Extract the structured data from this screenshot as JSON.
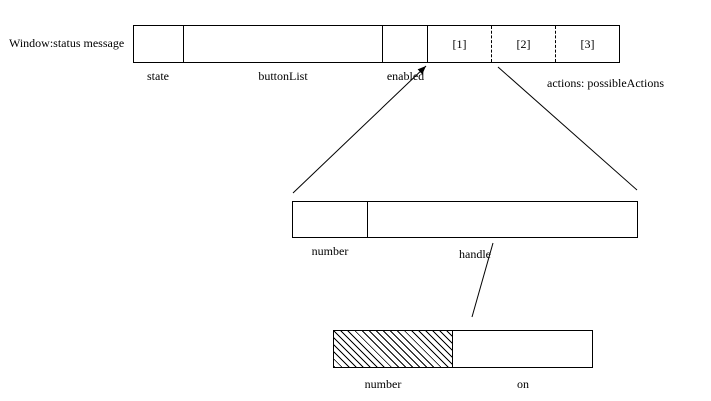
{
  "colors": {
    "line": "#000000",
    "background": "#ffffff"
  },
  "window_object": {
    "label": "Window:status message",
    "fields": [
      {
        "label": "state"
      },
      {
        "label": "buttonList"
      },
      {
        "label": "enabled"
      }
    ],
    "action_slots": [
      {
        "label": "[1]"
      },
      {
        "label": "[2]"
      },
      {
        "label": "[3]"
      }
    ],
    "actions_label": "actions: possibleActions"
  },
  "button_object": {
    "fields": [
      {
        "label": "number"
      },
      {
        "label": "handle"
      }
    ]
  },
  "state_object": {
    "fields": [
      {
        "label": "number"
      },
      {
        "label": "on"
      }
    ]
  }
}
